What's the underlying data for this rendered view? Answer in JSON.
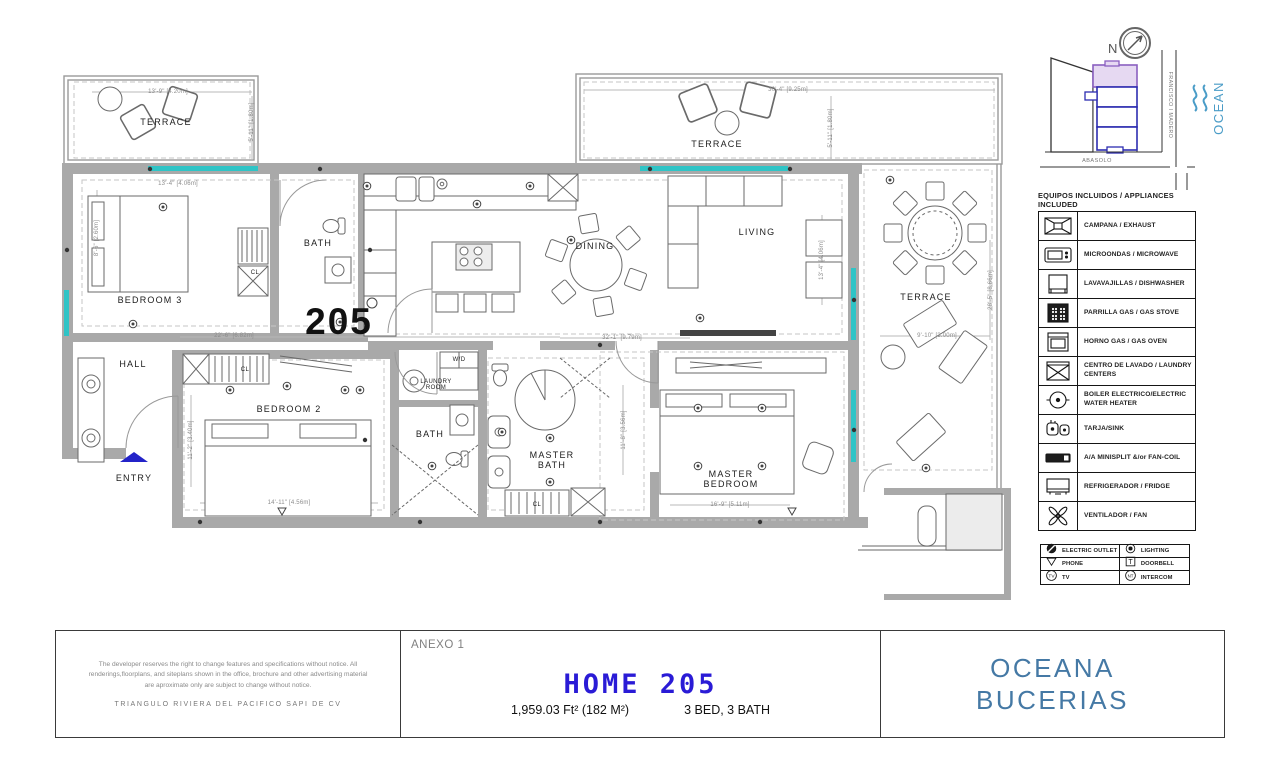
{
  "plan": {
    "unit_number": "205",
    "room_labels": [
      {
        "t": "TERRACE",
        "x": 166,
        "y": 122,
        "cls": "room"
      },
      {
        "t": "TERRACE",
        "x": 717,
        "y": 144,
        "cls": "room"
      },
      {
        "t": "TERRACE",
        "x": 926,
        "y": 297,
        "cls": "room"
      },
      {
        "t": "BEDROOM 3",
        "x": 150,
        "y": 300,
        "cls": "room"
      },
      {
        "t": "BATH",
        "x": 318,
        "y": 243,
        "cls": "room"
      },
      {
        "t": "HALL",
        "x": 133,
        "y": 364,
        "cls": "room"
      },
      {
        "t": "ENTRY",
        "x": 134,
        "y": 478,
        "cls": "room"
      },
      {
        "t": "BEDROOM 2",
        "x": 289,
        "y": 409,
        "cls": "room"
      },
      {
        "t": "BATH",
        "x": 430,
        "y": 434,
        "cls": "room"
      },
      {
        "t": "DINING",
        "x": 595,
        "y": 246,
        "cls": "room"
      },
      {
        "t": "LIVING",
        "x": 757,
        "y": 232,
        "cls": "room"
      },
      {
        "t": "MASTER\nBATH",
        "x": 552,
        "y": 460,
        "cls": "room"
      },
      {
        "t": "MASTER\nBEDROOM",
        "x": 731,
        "y": 479,
        "cls": "room"
      },
      {
        "t": "CL",
        "x": 255,
        "y": 273,
        "cls": "small"
      },
      {
        "t": "CL",
        "x": 245,
        "y": 370,
        "cls": "small"
      },
      {
        "t": "CL",
        "x": 537,
        "y": 505,
        "cls": "small"
      },
      {
        "t": "W/D",
        "x": 459,
        "y": 360,
        "cls": "small"
      },
      {
        "t": "LAUNDRY\nROOM",
        "x": 436,
        "y": 385,
        "cls": "small"
      }
    ],
    "dimension_labels": [
      {
        "t": "13'-9\" [4.20m]",
        "x": 168,
        "y": 92,
        "r": 0
      },
      {
        "t": "5'-11\" [1.80m]",
        "x": 252,
        "y": 122,
        "r": 90
      },
      {
        "t": "13'-4\" [4.06m]",
        "x": 178,
        "y": 184,
        "r": 0
      },
      {
        "t": "8'-6\" [2.60m]",
        "x": 97,
        "y": 238,
        "r": 90
      },
      {
        "t": "30'-4\" [9.25m]",
        "x": 788,
        "y": 90,
        "r": 0
      },
      {
        "t": "5'-11\" [1.80m]",
        "x": 831,
        "y": 128,
        "r": 90
      },
      {
        "t": "22'-6\" [6.82m]",
        "x": 234,
        "y": 336,
        "r": 0
      },
      {
        "t": "32'-1\" [9.79m]",
        "x": 622,
        "y": 338,
        "r": 0
      },
      {
        "t": "11'-2\" [3.40m]",
        "x": 191,
        "y": 440,
        "r": 90
      },
      {
        "t": "14'-11\" [4.56m]",
        "x": 289,
        "y": 503,
        "r": 0
      },
      {
        "t": "13'-4\" [4.06m]",
        "x": 822,
        "y": 260,
        "r": 90
      },
      {
        "t": "11'-8\" [3.56m]",
        "x": 624,
        "y": 430,
        "r": 90
      },
      {
        "t": "16'-9\" [5.11m]",
        "x": 730,
        "y": 505,
        "r": 0
      },
      {
        "t": "9'-10\" [3.00m]",
        "x": 937,
        "y": 336,
        "r": 0
      },
      {
        "t": "28'-5\" [8.66m]",
        "x": 991,
        "y": 290,
        "r": 90
      }
    ]
  },
  "site_map": {
    "north_label": "N",
    "street_vertical": "FRANCISCO I MADERO",
    "street_horizontal": "ABASOLO",
    "ocean_label": "OCEAN"
  },
  "legend": {
    "title": "EQUIPOS INCLUIDOS / APPLIANCES INCLUDED",
    "items": [
      {
        "icon": "exhaust-hood-icon",
        "label": "CAMPANA / EXHAUST"
      },
      {
        "icon": "microwave-icon",
        "label": "MICROONDAS / MICROWAVE"
      },
      {
        "icon": "dishwasher-icon",
        "label": "LAVAVAJILLAS / DISHWASHER"
      },
      {
        "icon": "gas-stove-icon",
        "label": "PARRILLA GAS / GAS STOVE"
      },
      {
        "icon": "gas-oven-icon",
        "label": "HORNO GAS / GAS OVEN"
      },
      {
        "icon": "laundry-center-icon",
        "label": "CENTRO DE LAVADO / LAUNDRY CENTERS"
      },
      {
        "icon": "water-heater-icon",
        "label": "BOILER ELECTRICO/ELECTRIC WATER HEATER"
      },
      {
        "icon": "sink-icon",
        "label": "TARJA/SINK"
      },
      {
        "icon": "minisplit-icon",
        "label": "A/A MINISPLIT &/or FAN-COIL"
      },
      {
        "icon": "fridge-icon",
        "label": "REFRIGERADOR / FRIDGE"
      },
      {
        "icon": "fan-icon",
        "label": "VENTILADOR / FAN"
      }
    ]
  },
  "symbols": {
    "rows": [
      [
        {
          "icon": "electric-outlet-icon",
          "label": "ELECTRIC OUTLET"
        },
        {
          "icon": "lighting-icon",
          "label": "LIGHTING"
        }
      ],
      [
        {
          "icon": "phone-icon",
          "label": "PHONE"
        },
        {
          "icon": "doorbell-icon",
          "label": "DOORBELL"
        }
      ],
      [
        {
          "icon": "tv-icon",
          "label": "TV"
        },
        {
          "icon": "intercom-icon",
          "label": "INTERCOM"
        }
      ]
    ]
  },
  "title_block": {
    "anexo": "ANEXO 1",
    "home_title": "HOME 205",
    "area": "1,959.03 Ft² (182 M²)",
    "beds_baths": "3 BED, 3 BATH",
    "disclaimer": "The developer reserves the right to change features and specifications without notice. All renderings,floorplans, and siteplans shown in the office, brochure and other advertising material are aproximate only are subject to change without notice.",
    "company": "TRIANGULO RIVIERA DEL PACIFICO SAPI DE CV",
    "brand_line1": "OCEANA",
    "brand_line2": "BUCERIAS"
  },
  "colors": {
    "home_title_blue": "#2a1bd6",
    "brand_blue": "#4579a5",
    "window_teal": "#2fc4c6",
    "wall_gray": "#a9a9a9",
    "unit_highlight_purple": "#e6d9f2",
    "site_building_blue": "#2d2db0",
    "ocean_blue": "#4a9cc7",
    "entry_arrow_blue": "#2323c8"
  }
}
